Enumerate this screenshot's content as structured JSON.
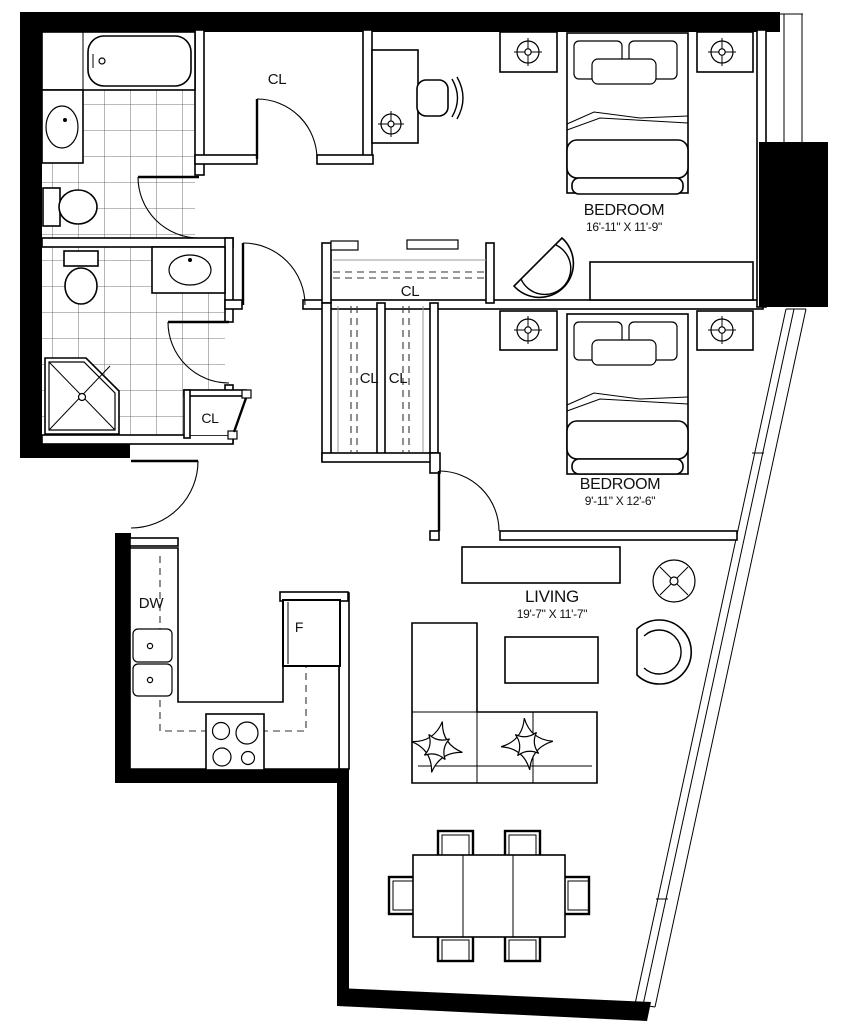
{
  "plan": {
    "rooms": {
      "bedroom1": {
        "name": "BEDROOM",
        "dims": "16'-11\" X 11'-9\""
      },
      "bedroom2": {
        "name": "BEDROOM",
        "dims": "9'-11\" X 12'-6\""
      },
      "living": {
        "name": "LIVING",
        "dims": "19'-7\" X 11'-7\""
      }
    },
    "closets": {
      "entry": "CL",
      "bedroom1": "CL",
      "hall_left": "CL",
      "hall_right": "CL",
      "linen": "CL"
    },
    "appliances": {
      "dishwasher": "DW",
      "refrigerator": "F"
    },
    "colors": {
      "walls": "#000000",
      "lines": "#111111",
      "background": "#ffffff"
    }
  }
}
